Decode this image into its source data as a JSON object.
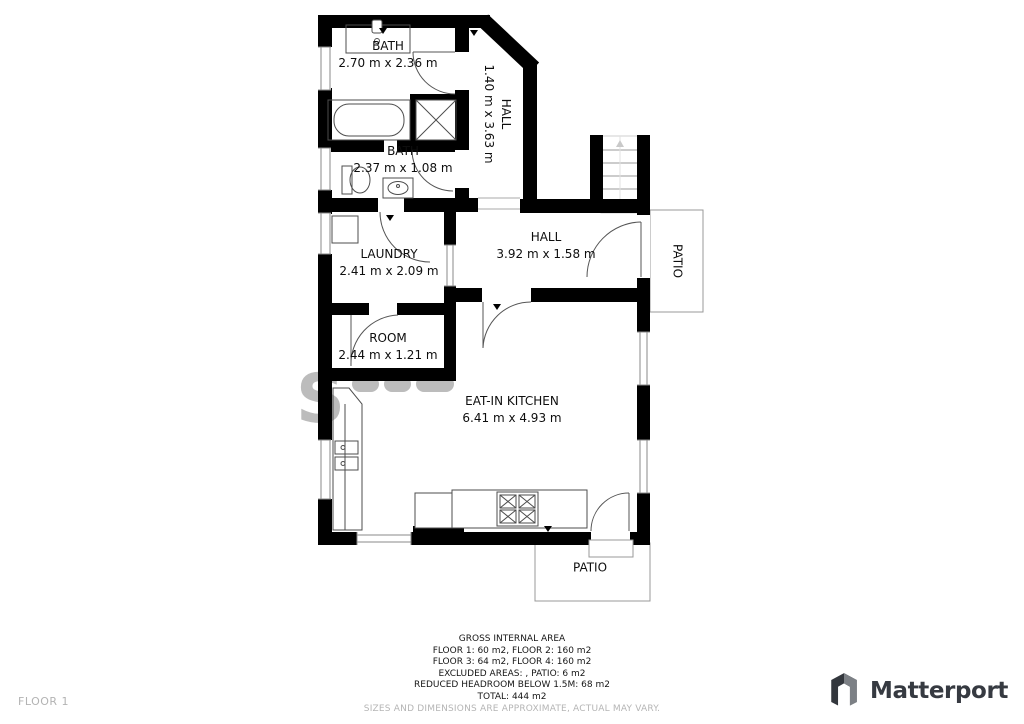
{
  "plan": {
    "bath_top": {
      "name": "BATH",
      "dims": "2.70 m x 2.36 m"
    },
    "hall_upper": {
      "name": "HALL",
      "dims": "1.40 m x 3.63 m"
    },
    "bath_small": {
      "name": "BATH",
      "dims": "2.37 m x 1.08 m"
    },
    "laundry": {
      "name": "LAUNDRY",
      "dims": "2.41 m x 2.09 m"
    },
    "hall_lower": {
      "name": "HALL",
      "dims": "3.92 m x 1.58 m"
    },
    "room": {
      "name": "ROOM",
      "dims": "2.44 m x 1.21 m"
    },
    "kitchen": {
      "name": "EAT-IN KITCHEN",
      "dims": "6.41 m x 4.93 m"
    },
    "patio_right": {
      "name": "PATIO"
    },
    "patio_bottom": {
      "name": "PATIO"
    }
  },
  "watermark": "S",
  "footer": {
    "floor_label": "FLOOR 1",
    "area_summary": [
      "GROSS INTERNAL AREA",
      "FLOOR 1: 60 m2, FLOOR 2: 160 m2",
      "FLOOR 3: 64 m2, FLOOR 4: 160 m2",
      "EXCLUDED AREAS: , PATIO: 6 m2",
      "REDUCED HEADROOM BELOW 1.5M: 68 m2",
      "TOTAL: 444 m2"
    ],
    "disclaimer": "SIZES AND DIMENSIONS ARE APPROXIMATE, ACTUAL MAY VARY.",
    "brand": "Matterport"
  },
  "colors": {
    "wall": "#000000",
    "fixture_stroke": "#4d4d4d",
    "patio_stroke": "#999999",
    "watermark": "#bcbcbc",
    "brand_dark": "#363a41",
    "muted_text": "#b5b5b5"
  }
}
